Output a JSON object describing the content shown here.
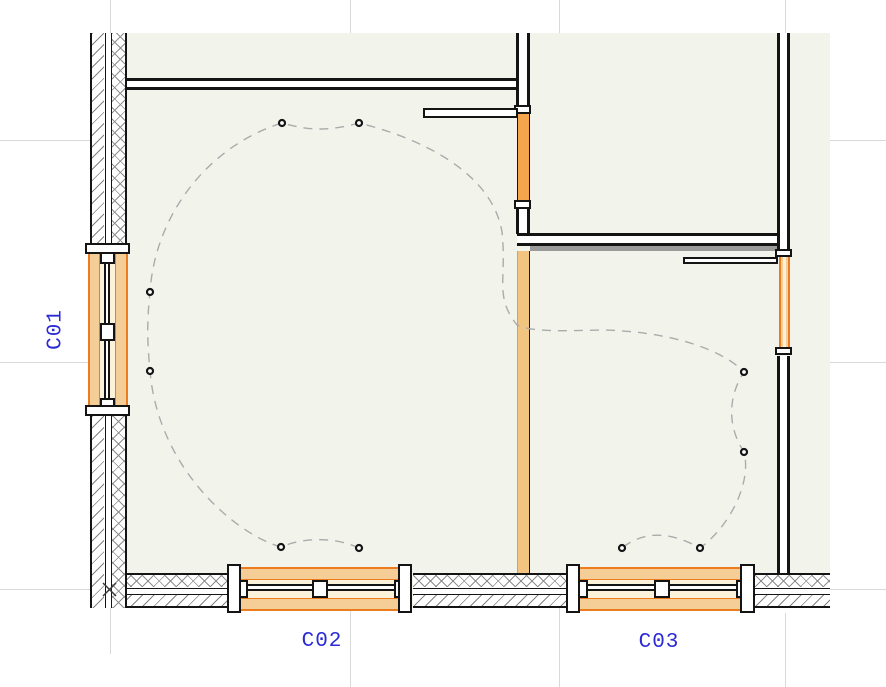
{
  "labels": {
    "c01": "C01",
    "c02": "C02",
    "c03": "C03"
  },
  "colors": {
    "room_fill": "#F2F4EC",
    "grid": "#D9D9D9",
    "wall_line": "#141414",
    "hatch_gray": "#8E8E8E",
    "window_border": "#EC7C1E",
    "window_fill": "#F5CE97",
    "window_glass_band": "#FBF2D9",
    "door_orange": "#F5A54C",
    "new_wall_orange": "#F1C480",
    "label_blue": "#2B2BD5",
    "wiring_gray": "#ABABAB"
  },
  "lights": [
    [
      282,
      123
    ],
    [
      359,
      123
    ],
    [
      150,
      292
    ],
    [
      150,
      371
    ],
    [
      281,
      547
    ],
    [
      359,
      548
    ],
    [
      744,
      372
    ],
    [
      744,
      452
    ],
    [
      700,
      548
    ],
    [
      622,
      548
    ]
  ],
  "wiring_path": "M 359,548 C 333,536 302,538 281,547 C 235,534 158,468 150,371 C 147,340 147,320 150,292 C 155,215 208,146 282,123 C 310,131 330,131 359,123 C 420,138 492,172 502,232 C 507,280 494,296 517,325 C 533,332 560,331 601,330 C 668,331 722,349 744,372 C 727,398 728,428 744,452 C 752,483 729,527 700,548 C 673,533 646,529 622,548",
  "corner_marker": {
    "x1": 103,
    "y1": 583,
    "x2": 116,
    "y2": 596
  }
}
